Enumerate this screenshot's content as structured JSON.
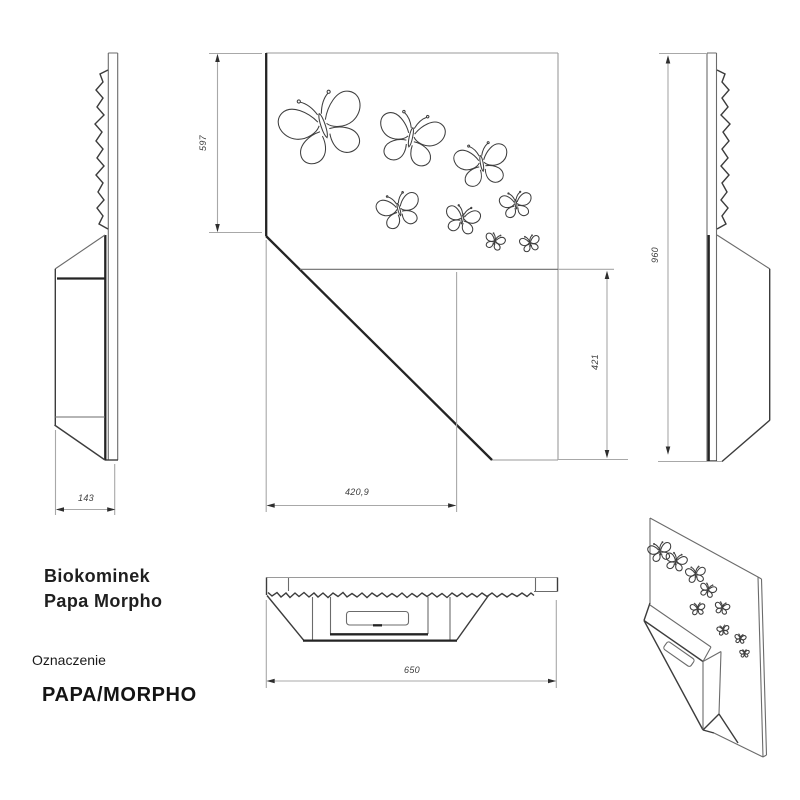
{
  "page": {
    "background": "#ffffff"
  },
  "product": {
    "title_line1": "Biokominek",
    "title_line2": "Papa Morpho",
    "designation_label": "Oznaczenie",
    "designation_value": "PAPA/MORPHO"
  },
  "dimensions": {
    "depth_mm": "143",
    "panel_height_mm": "597",
    "lower_section_height_mm": "421",
    "lower_section_width_mm": "420,9",
    "overall_width_mm": "650",
    "overall_height_mm": "960"
  },
  "drawing": {
    "motif": "butterfly-cutouts",
    "line_color": "#6b6b6b",
    "bold_line_color": "#242424",
    "dimension_line_color": "#a8a8a8",
    "label_color": "#3c3c3c"
  }
}
